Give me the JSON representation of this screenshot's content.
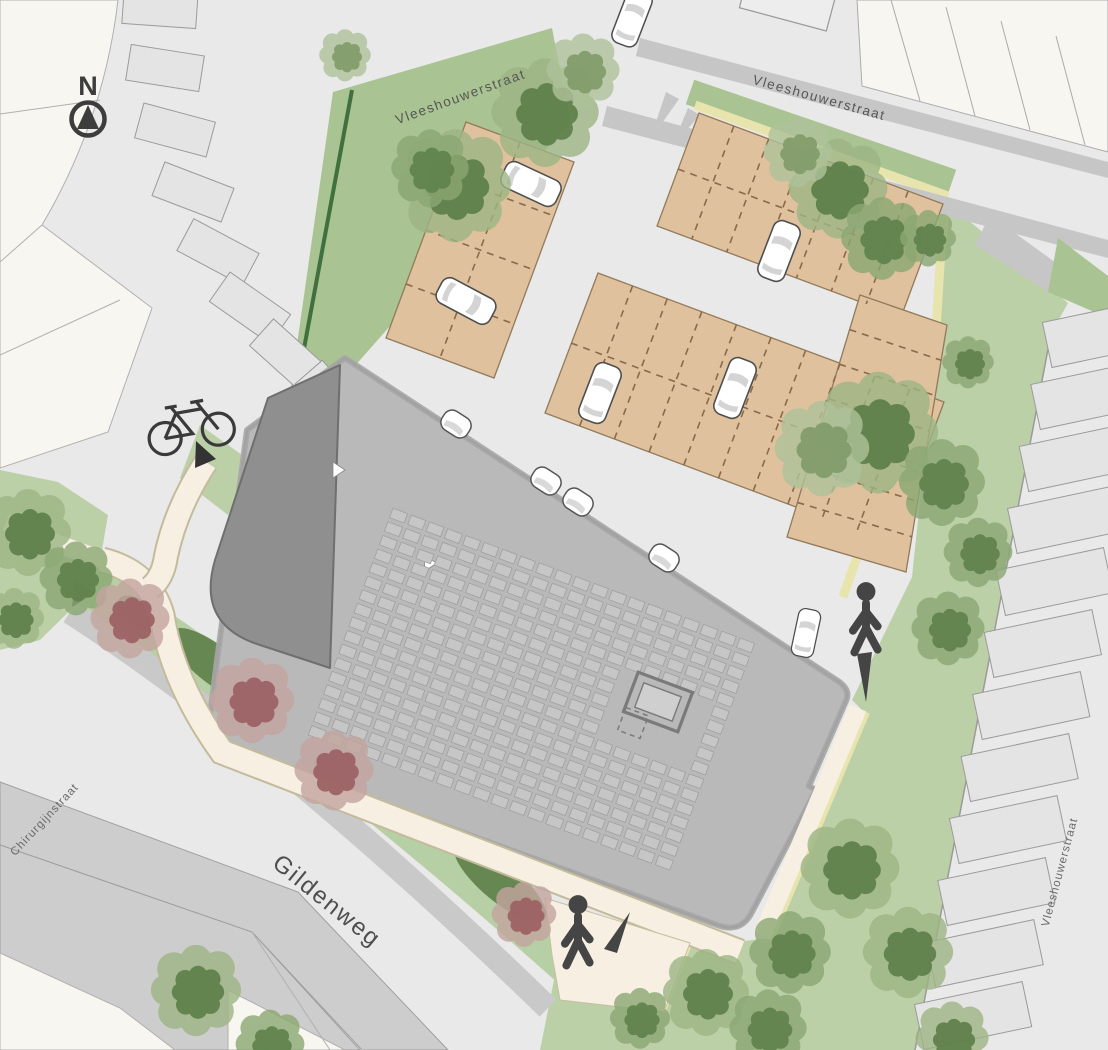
{
  "plan": {
    "north_label": "N",
    "streets": {
      "top": "Vleeshouwerstraat",
      "top_right": "Vleeshouwerstraat",
      "right": "Vleeshouwerstraat",
      "left": "Chirurgijnstraat",
      "bottom": "Gildenweg"
    },
    "icons": {
      "north_arrow": "compass-north-arrow",
      "bicycle": "bicycle-parking",
      "pedestrian": "pedestrian-walking",
      "pedestrian_direction": "direction-arrow",
      "give_way": "give-way-road-marking",
      "car": "parked-car",
      "tree": "tree-canopy",
      "blossom_tree": "blossom-tree"
    },
    "colors": {
      "road": "#e9e9e9",
      "sidewalk": "#c6c6c6",
      "parcel": "#f7f6f1",
      "building_roof": "#b9b9b9",
      "building_wing": "#8f8f8f",
      "solar_panel": "#c6c6c6",
      "parking_paving": "#dfc19d",
      "stall_marking": "#8a6a4a",
      "lawn": "#bcd0a8",
      "tree_green": "#5e7f4a",
      "tree_blossom": "#9d6164",
      "path": "#f6efe2",
      "accent_edge": "#e8e4ad",
      "hedge": "#41703f",
      "car": "#ffffff",
      "figure": "#454545"
    }
  }
}
